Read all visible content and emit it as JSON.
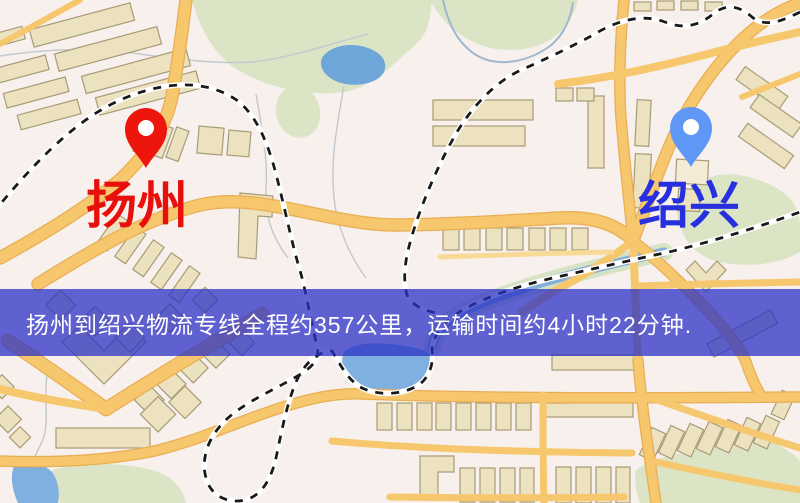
{
  "route_banner": {
    "text": "扬州到绍兴物流专线全程约357公里，运输时间约4小时22分钟.",
    "overlay_color": "#2b32c6",
    "overlay_opacity": "0.75",
    "text_color": "#ffffff"
  },
  "markers": {
    "origin": {
      "name": "扬州",
      "label_color": "#e8100c",
      "pin_color": "#ee150d"
    },
    "destination": {
      "name": "绍兴",
      "label_color": "#2630df",
      "pin_color": "#5e97f5"
    }
  },
  "map_palette": {
    "background": "#f7f0ec",
    "road_fill": "#f6c76c",
    "road_casing": "#e9ae54",
    "road_minor": "#f8d995",
    "building_fill": "#ece2c0",
    "building_outline": "#a89b76",
    "green_area": "#dbe5c6",
    "water": "#6fa6d9",
    "water_light": "#7fb0e0",
    "railway_dash": "#1a1a1a",
    "stream": "#c2c8cd"
  }
}
